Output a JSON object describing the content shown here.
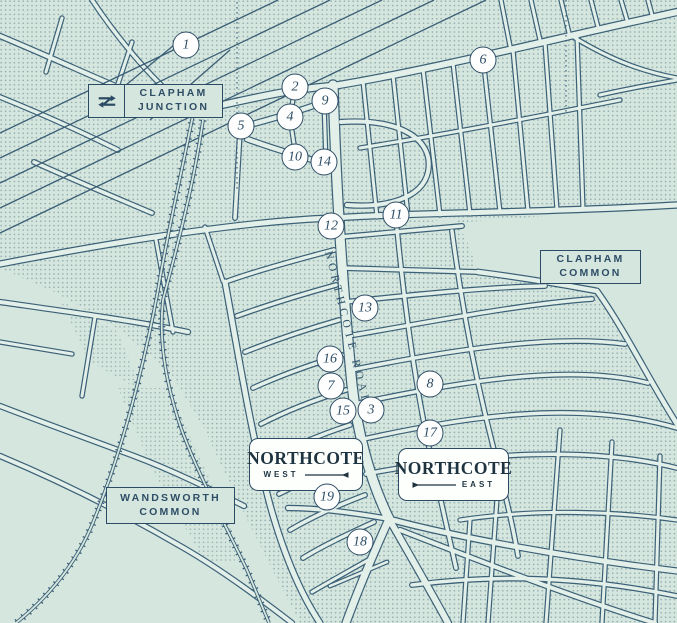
{
  "map": {
    "region_labels": [
      {
        "id": "clapham-junction",
        "lines": [
          "CLAPHAM",
          "JUNCTION"
        ],
        "has_rail_logo": true
      },
      {
        "id": "clapham-common",
        "lines": [
          "CLAPHAM",
          "COMMON"
        ],
        "has_rail_logo": false
      },
      {
        "id": "wandsworth-common",
        "lines": [
          "WANDSWORTH",
          "COMMON"
        ],
        "has_rail_logo": false
      }
    ],
    "area_cards": [
      {
        "id": "northcote-west",
        "title": "NORTHCOTE",
        "subtitle": "WEST",
        "arrow_side": "right"
      },
      {
        "id": "northcote-east",
        "title": "NORTHCOTE",
        "subtitle": "EAST",
        "arrow_side": "left"
      }
    ],
    "road_label": "NORTHCOTE ROAD",
    "markers": [
      {
        "number": "1",
        "x": 186,
        "y": 45
      },
      {
        "number": "2",
        "x": 295,
        "y": 87
      },
      {
        "number": "3",
        "x": 371,
        "y": 410
      },
      {
        "number": "4",
        "x": 290,
        "y": 117
      },
      {
        "number": "5",
        "x": 241,
        "y": 126
      },
      {
        "number": "6",
        "x": 483,
        "y": 60
      },
      {
        "number": "7",
        "x": 331,
        "y": 386
      },
      {
        "number": "8",
        "x": 430,
        "y": 384
      },
      {
        "number": "9",
        "x": 325,
        "y": 101
      },
      {
        "number": "10",
        "x": 295,
        "y": 157
      },
      {
        "number": "11",
        "x": 396,
        "y": 215
      },
      {
        "number": "12",
        "x": 331,
        "y": 226
      },
      {
        "number": "13",
        "x": 365,
        "y": 308
      },
      {
        "number": "14",
        "x": 324,
        "y": 162
      },
      {
        "number": "15",
        "x": 343,
        "y": 411
      },
      {
        "number": "16",
        "x": 330,
        "y": 359
      },
      {
        "number": "17",
        "x": 430,
        "y": 433
      },
      {
        "number": "18",
        "x": 360,
        "y": 542
      },
      {
        "number": "19",
        "x": 327,
        "y": 497
      }
    ],
    "colors": {
      "navy": "#2b4a63",
      "street_line": "#3c6177",
      "base_mint": "#d5e6de",
      "road_fill": "#e3efe9",
      "card_white": "#fdfffd",
      "dot": "#47707f"
    }
  }
}
